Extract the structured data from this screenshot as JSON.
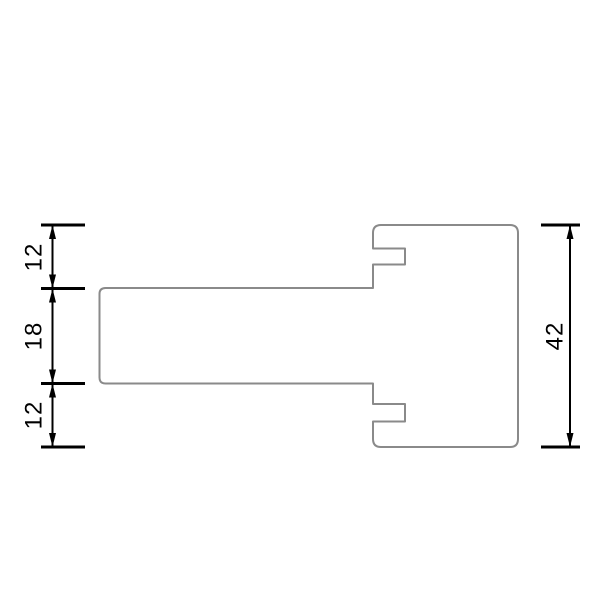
{
  "diagram": {
    "type": "technical-drawing-cross-section",
    "background": "#ffffff",
    "profile": {
      "outline_color": "#8a8a8a"
    },
    "dimensions": {
      "color": "#000000",
      "left_chain": [
        {
          "label": "12"
        },
        {
          "label": "18"
        },
        {
          "label": "12"
        }
      ],
      "right_total": {
        "label": "42"
      }
    }
  }
}
